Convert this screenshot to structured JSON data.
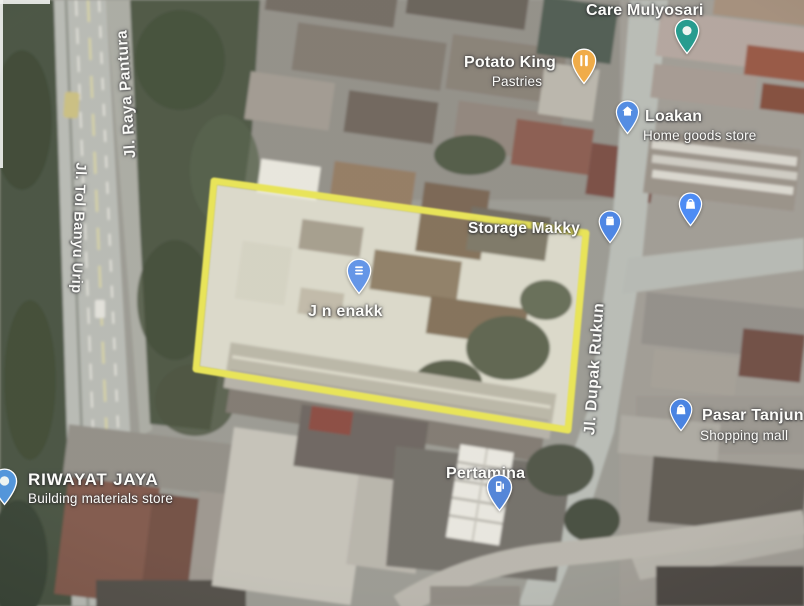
{
  "map": {
    "highlight": {
      "color": "#e7e24f"
    },
    "road_labels": [
      {
        "id": "raya-pantura",
        "text": "Jl. Raya Pantura"
      },
      {
        "id": "tol-banyu-urip",
        "text": "Jl. Tol Banyu Urip"
      },
      {
        "id": "dupak-rukun",
        "text": "Jl. Dupak Rukun"
      }
    ],
    "places": [
      {
        "id": "care-mulyosari",
        "name": "Care Mulyosari",
        "pin_color": "#1a9688",
        "icon": "generic-place-icon"
      },
      {
        "id": "potato-king",
        "name": "Potato King",
        "subtitle": "Pastries",
        "pin_color": "#efa73e",
        "icon": "restaurant-icon"
      },
      {
        "id": "loakan",
        "name": "Loakan",
        "subtitle": "Home goods store",
        "pin_color": "#4a86e0",
        "icon": "home-icon"
      },
      {
        "id": "storage-makky",
        "name": "Storage Makky",
        "pin_color": "#4480e2",
        "icon": "storage-box-icon"
      },
      {
        "id": "jn-enakk",
        "name": "J n enakk",
        "pin_color": "#5b8fe6",
        "icon": "menu-lines-icon"
      },
      {
        "id": "pasar-tanjun",
        "name": "Pasar Tanjun",
        "subtitle": "Shopping mall",
        "pin_color": "#3f7ce0",
        "icon": "shopping-bag-icon"
      },
      {
        "id": "pertamina",
        "name": "Pertamina",
        "pin_color": "#4a7fd6",
        "icon": "fuel-pump-icon"
      },
      {
        "id": "riwayat-jaya",
        "name": "RIWAYAT JAYA",
        "subtitle": "Building materials store",
        "pin_color": "#4a90d9",
        "icon": "store-icon"
      },
      {
        "id": "unlabeled-place",
        "name": "",
        "pin_color": "#4285f4",
        "icon": "shopping-bag-icon"
      }
    ]
  }
}
